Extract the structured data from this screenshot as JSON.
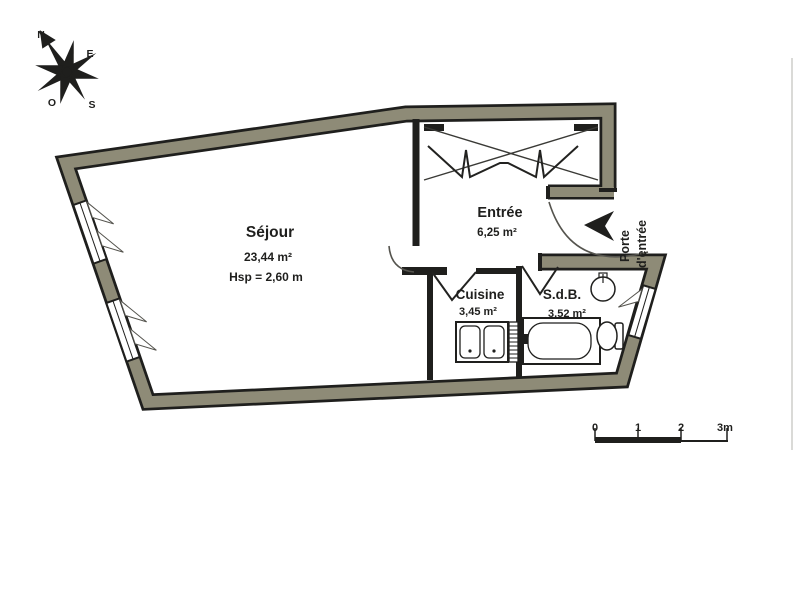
{
  "compass": {
    "n": "N",
    "e": "E",
    "s": "S",
    "o": "O"
  },
  "rooms": {
    "sejour": {
      "name": "Séjour",
      "area": "23,44 m²",
      "height": "Hsp = 2,60 m"
    },
    "entree": {
      "name": "Entrée",
      "area": "6,25 m²"
    },
    "cuisine": {
      "name": "Cuisine",
      "area": "3,45 m²"
    },
    "sdb": {
      "name": "S.d.B.",
      "area": "3,52 m²"
    }
  },
  "entrance": {
    "line1": "Porte",
    "line2": "d'entrée"
  },
  "scale": {
    "ticks": [
      "0",
      "1",
      "2",
      "3m"
    ]
  },
  "colors": {
    "wall": "#8e8b77",
    "ink": "#1f1f1d",
    "paper": "#ffffff"
  }
}
